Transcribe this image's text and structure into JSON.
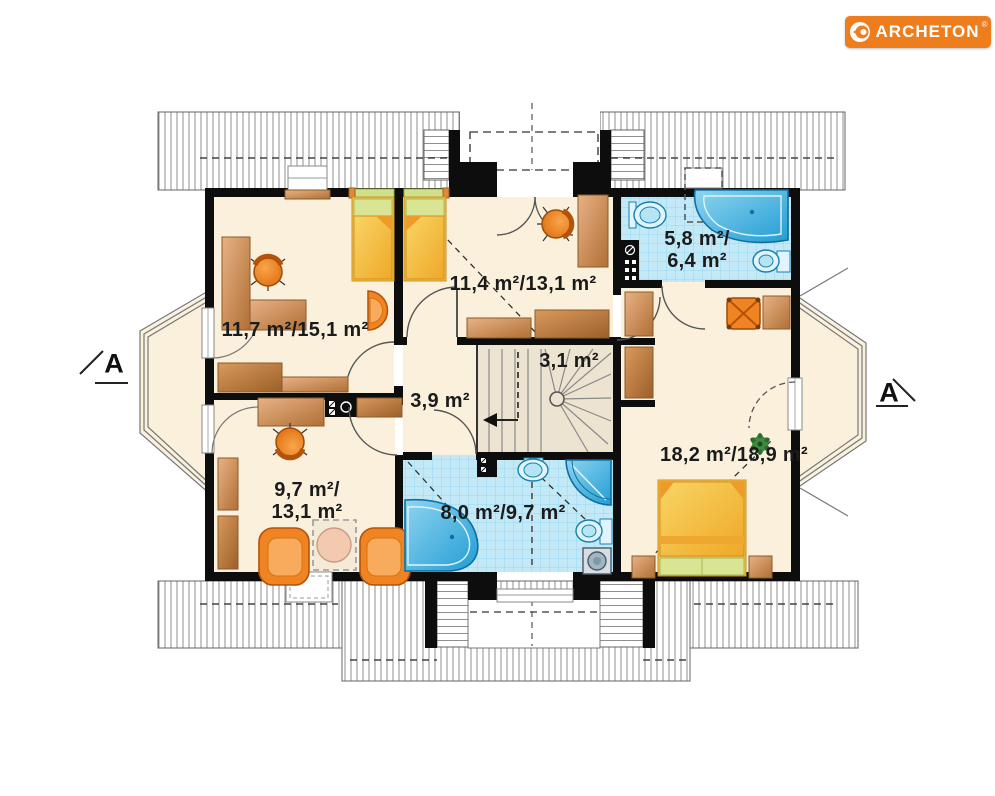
{
  "logo": {
    "text": "ARCHETON",
    "registered": "®"
  },
  "section_markers": {
    "left": "A",
    "right": "A"
  },
  "rooms": [
    {
      "name": "bedroom-top-left",
      "label": "11,7 m²/15,1 m²"
    },
    {
      "name": "bedroom-top-middle",
      "label": "11,4 m²/13,1 m²"
    },
    {
      "name": "bathroom-top",
      "label": "5,8 m²/",
      "label2": "6,4 m²"
    },
    {
      "name": "staircase",
      "label": "3,1 m²"
    },
    {
      "name": "hallway",
      "label": "3,9 m²"
    },
    {
      "name": "room-bottom-left",
      "label": "9,7 m²/",
      "label2": "13,1 m²"
    },
    {
      "name": "bathroom-bottom",
      "label": "8,0 m²/9,7 m²"
    },
    {
      "name": "bedroom-right",
      "label": "18,2 m²/18,9 m²"
    }
  ],
  "colors": {
    "logo_bg": "#ee7d1e",
    "wall": "#0d0d0d",
    "floor_cream": "#faf0dc",
    "stair_floor": "#ece3d0",
    "tile_blue": "#c3e9f7",
    "fixture_blue": "#2fa9dd",
    "wood": "#cf8f52",
    "accent_orange": "#f08522",
    "bed_yellow": "#f4bc3e",
    "pillow_green": "#d9e494",
    "plant_green": "#2f6b2f",
    "text": "#1b1b1b"
  }
}
